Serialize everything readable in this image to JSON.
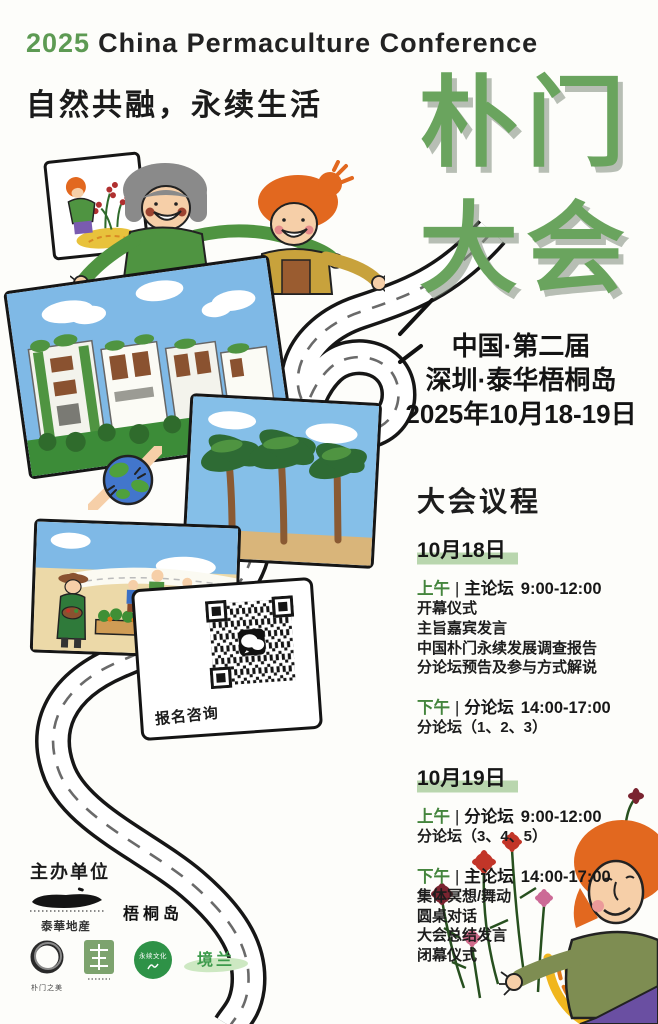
{
  "colors": {
    "title_green": "#6aa45e",
    "agenda_green": "#44853d",
    "date_highlight": "#b9d6ae",
    "text_black": "#1b1b1b",
    "sky_blue": "#7fb9e6",
    "road_white": "#ffffff"
  },
  "header": {
    "year": "2025",
    "title_en": "China Permaculture Conference",
    "slogan": "自然共融，永续生活"
  },
  "main_title": {
    "line1": "朴门",
    "line2": "大会"
  },
  "event_info": {
    "edition": "中国·第二届",
    "venue": "深圳·泰华梧桐岛",
    "dates": "2025年10月18-19日"
  },
  "agenda": {
    "title": "大会议程",
    "separator": "|",
    "days": [
      {
        "date": "10月18日",
        "sessions": [
          {
            "period": "上午",
            "forum": "主论坛",
            "time": "9:00-12:00",
            "items": [
              "开幕仪式",
              "主旨嘉宾发言",
              "中国朴门永续发展调查报告",
              "分论坛预告及参与方式解说"
            ]
          },
          {
            "period": "下午",
            "forum": "分论坛",
            "time": "14:00-17:00",
            "items": [
              "分论坛（1、2、3）"
            ]
          }
        ]
      },
      {
        "date": "10月19日",
        "sessions": [
          {
            "period": "上午",
            "forum": "分论坛",
            "time": "9:00-12:00",
            "items": [
              "分论坛（3、4、5）"
            ]
          },
          {
            "period": "下午",
            "forum": "主论坛",
            "time": "14:00-17:00",
            "items": [
              "集体冥想/舞动",
              "圆桌对话",
              "大会总结发言",
              "闭幕仪式"
            ]
          }
        ]
      }
    ]
  },
  "qr_card": {
    "label": "报名咨询",
    "icon": "wechat-icon"
  },
  "organizers": {
    "label": "主办单位",
    "taihua": "泰華地産",
    "wutong": "梧桐岛",
    "enso_label": "朴门之美",
    "yongxu": "永续文化",
    "jinglan": "境兰"
  }
}
